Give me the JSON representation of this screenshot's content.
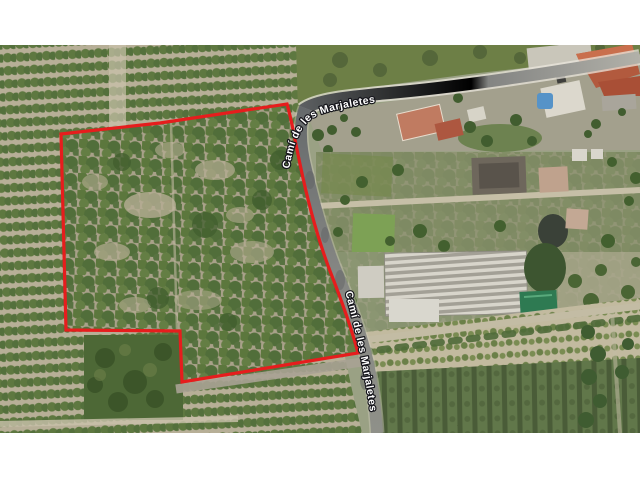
{
  "map": {
    "road_label_upper": "Camí de les Marjaletes",
    "road_label_lower": "Camí de les Marjaletes",
    "colors": {
      "parcel_outline": "#e61d1d",
      "label_text": "#ffffff",
      "pool": "#5693c8",
      "roof_terracotta": "#b25a3e",
      "green_roof": "#2e7a52"
    }
  }
}
